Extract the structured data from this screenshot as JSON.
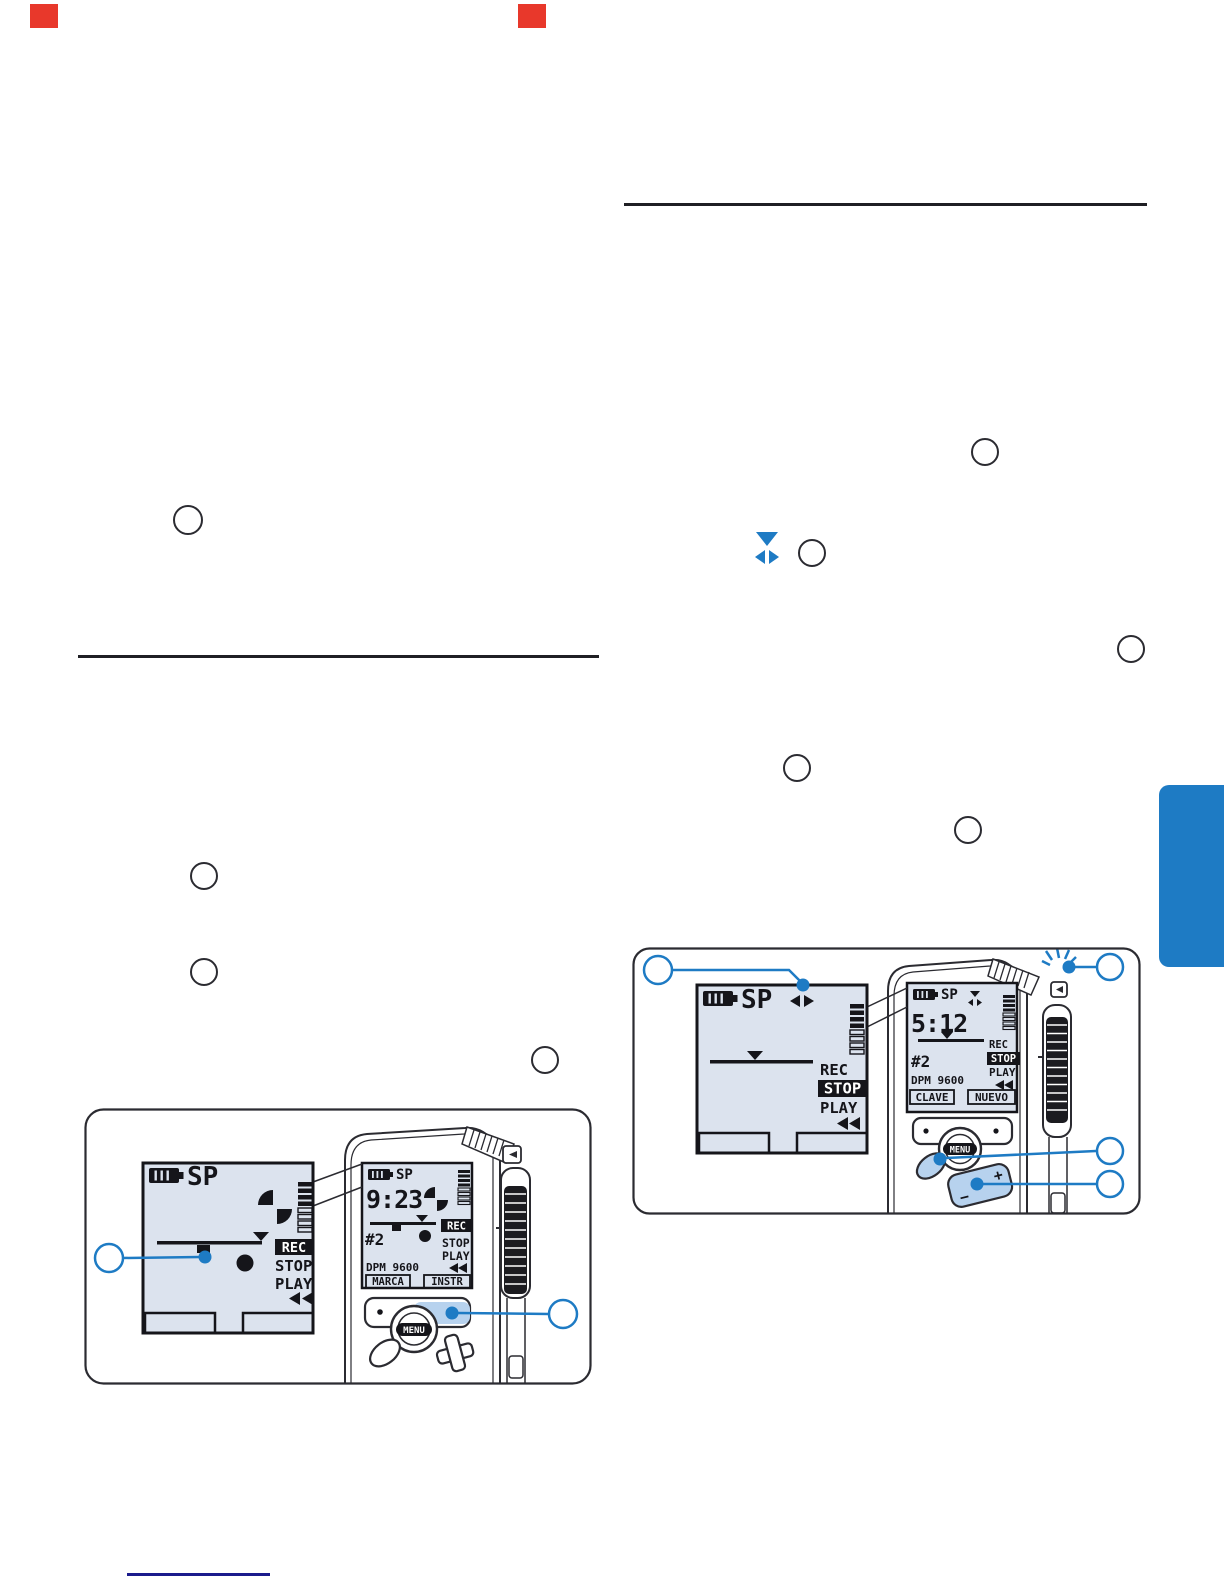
{
  "page": {
    "background": "#FFFFFF",
    "accent_blue": "#1E7BC4",
    "button_blue": "#B7D2EE",
    "lcd_background": "#DCE3EE",
    "ink": "#15151A",
    "red_mark_color": "#E8382B",
    "link_line_color": "#1B1B8C"
  },
  "left_panel": {
    "large_lcd": {
      "mode": "SP",
      "rec": "REC",
      "stop": "STOP",
      "play": "PLAY",
      "active": "REC"
    },
    "device": {
      "lcd": {
        "mode": "SP",
        "time": "9:23",
        "file": "#2",
        "model": "DPM 9600",
        "softkey_left": "MARCA",
        "softkey_right": "INSTR",
        "rec": "REC",
        "stop": "STOP",
        "play": "PLAY",
        "active": "REC"
      },
      "menu_button": "MENU"
    }
  },
  "right_panel": {
    "large_lcd": {
      "mode": "SP",
      "rec": "REC",
      "stop": "STOP",
      "play": "PLAY",
      "active": "STOP"
    },
    "device": {
      "lcd": {
        "mode": "SP",
        "time": "5:12",
        "file": "#2",
        "model": "DPM 9600",
        "softkey_left": "CLAVE",
        "softkey_right": "NUEVO",
        "rec": "REC",
        "stop": "STOP",
        "play": "PLAY",
        "active": "STOP"
      },
      "menu_button": "MENU",
      "plus": "+",
      "minus": "−"
    }
  }
}
